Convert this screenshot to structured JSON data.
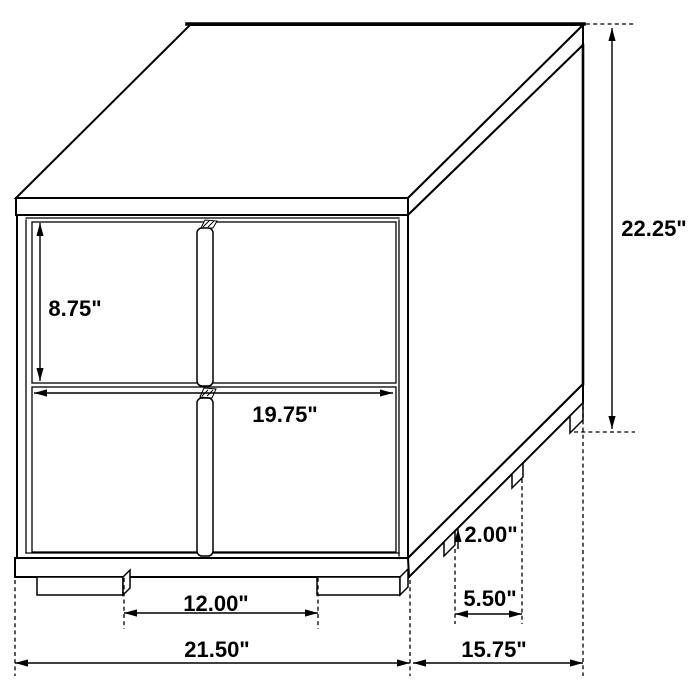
{
  "diagram": {
    "background": "#ffffff",
    "line_color": "#000000",
    "labels": {
      "upper_drawer_height": "8.75\"",
      "overall_height": "22.25\"",
      "drawer_width": "19.75\"",
      "front_leg_spacing": "12.00\"",
      "overall_width": "21.50\"",
      "leg_height": "2.00\"",
      "side_leg_spacing": "5.50\"",
      "overall_depth": "15.75\""
    }
  }
}
